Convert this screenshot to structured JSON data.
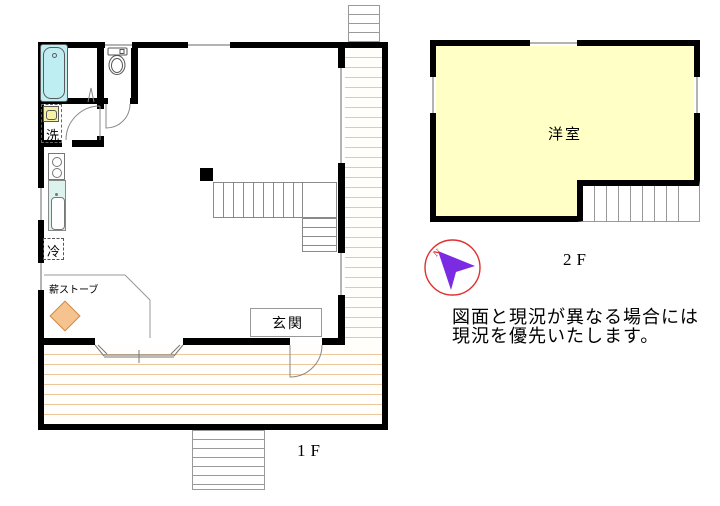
{
  "floor1": {
    "label": "1F",
    "entrance_label": "玄関",
    "washer_label": "洗",
    "fridge_label": "冷",
    "wood_stove_label": "薪ストーブ"
  },
  "floor2": {
    "label": "2F",
    "room_label": "洋室"
  },
  "compass": {
    "north_label": "N"
  },
  "disclaimer": {
    "line1": "図面と現況が異なる場合には",
    "line2": "現況を優先いたします。"
  },
  "colors": {
    "wall": "#000000",
    "deck_line": "#ecc69c",
    "room_2f_fill": "#ffffc6",
    "bathtub_fill": "#bfeef2",
    "washer_fill": "#f6f2a6",
    "counter_fill": "#dcf2ec",
    "wood_stove_fill": "#f6c28e",
    "compass_circle": "#e03030",
    "compass_arrow": "#7b2be2"
  }
}
